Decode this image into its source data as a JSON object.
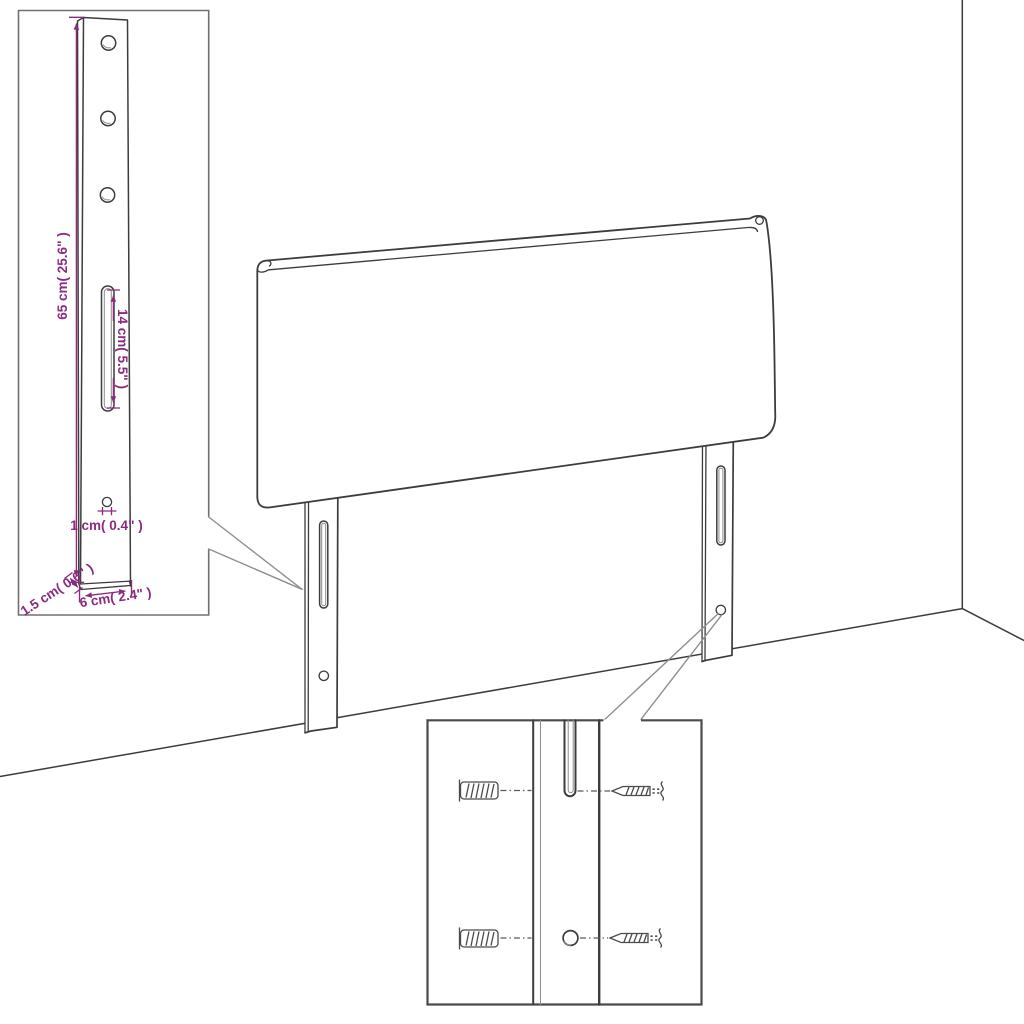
{
  "diagram": {
    "kind": "product dimension diagram",
    "subject": "headboard with two slotted wall-mount legs shown against a room corner",
    "insets": [
      "leg-dimension-detail",
      "wall-mounting-hardware-detail"
    ]
  },
  "colors": {
    "background": "#ffffff",
    "line_art": "#3c3c3c",
    "dimension_accent": "#8a2b80",
    "callout": "#8f8f8f",
    "inset_border": "#707070",
    "hardware": "#4a4a4a"
  },
  "leg_detail_inset": {
    "dim_height": "65 cm( 25.6\" )",
    "dim_slot_length": "14 cm( 5.5\" )",
    "dim_hole_diameter": "1 cm( 0.4\" )",
    "dim_thickness": "1.5 cm( 0.6\" )",
    "dim_width": "6 cm( 2.4\" )"
  },
  "mounting_inset": {
    "icons": {
      "wall_plug": "wall-plug-icon",
      "screw": "screw-icon"
    }
  }
}
